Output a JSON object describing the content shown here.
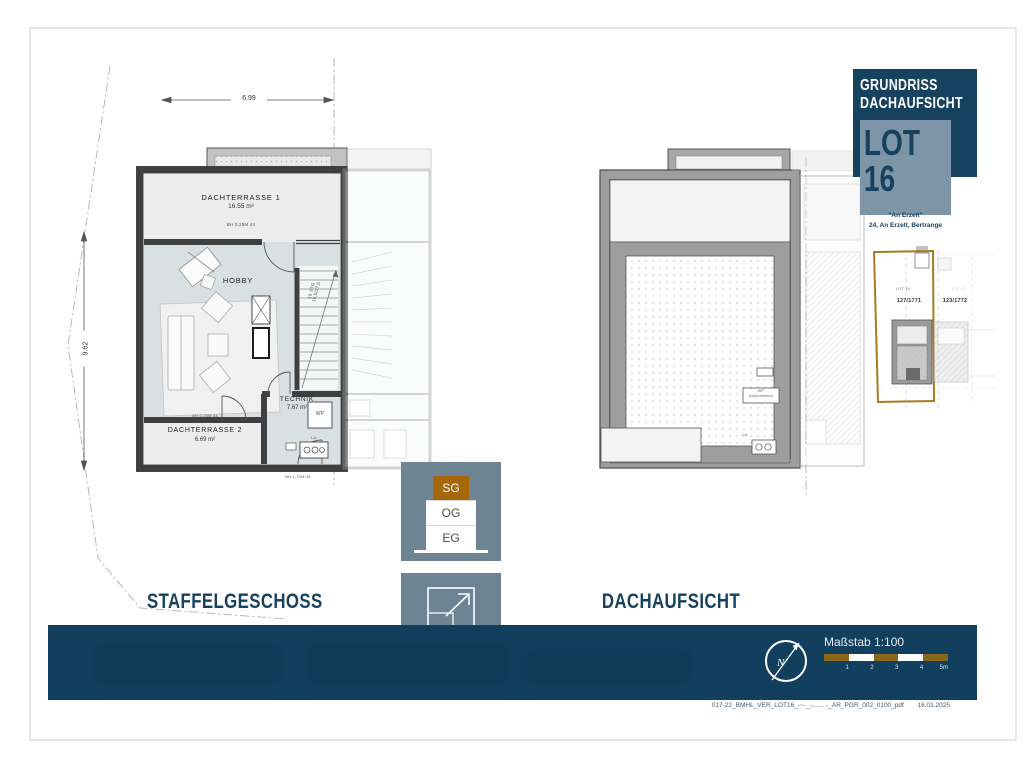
{
  "title_block": {
    "heading_line1": "GRUNDRISS",
    "heading_line2": "DACHAUFSICHT",
    "lot": "LOT 16",
    "project_name": "\"An Erzelt\"",
    "address": "24, An Erzelt, Bertrange"
  },
  "site_plan": {
    "lot_left_label": "LOT 16",
    "lot_right_label": "LOT 17",
    "parcel_left": "127/1771",
    "parcel_right": "123/1772"
  },
  "left_plan": {
    "dim_width": "6.99",
    "dim_height": "9.62",
    "rooms": [
      {
        "name": "DACHTERRASSE 1",
        "area": "16.55 m²"
      },
      {
        "name": "HOBBY",
        "area": ""
      },
      {
        "name": "TECHNIK",
        "area": "7.67 m²"
      },
      {
        "name": "DACHTERRASSE 2",
        "area": "6.69 m²"
      }
    ],
    "ann_t1": "BH 0,25M 44",
    "ann_t2": "BH 0,25M 44",
    "ann_bottom": "BH 1,70M 44",
    "stairs_line1": "16 STG",
    "stairs_line2": "18,5/27,5",
    "wp": "WP",
    "lu": "LÜ"
  },
  "right_plan": {
    "wp_line1": "WP",
    "wp_line2": "Außeneinheit",
    "lu": "LÜ"
  },
  "captions": {
    "left": "STAFFELGESCHOSS",
    "right": "DACHAUFSICHT"
  },
  "floor_selector": {
    "floors": [
      {
        "label": "SG",
        "active": true
      },
      {
        "label": "OG",
        "active": false
      },
      {
        "label": "EG",
        "active": false
      }
    ]
  },
  "area_badge": {
    "floor": "SG",
    "area": "35,37m²"
  },
  "footer": {
    "scale_label": "Maßstab 1:100",
    "scale_ticks": [
      "1",
      "2",
      "3",
      "4",
      "5m"
    ],
    "north": "N",
    "file_name": "017-22_BMHL_VER_LOT16_-~-_-........-_AR_PGR_002_0100_pdf",
    "date": "16.01.2025"
  },
  "colors": {
    "navy": "#16415f",
    "steel": "#7d95a6",
    "panel": "#6d8495",
    "accent_brown": "#a8660b",
    "scale_gold": "#8a671b",
    "parcel_gold": "#a87a1d",
    "wall_dark": "#3f3f3f",
    "parapet_gray": "#9e9e9e",
    "hobby_fill": "#d9e0e4",
    "terrace_fill": "#ededed"
  }
}
